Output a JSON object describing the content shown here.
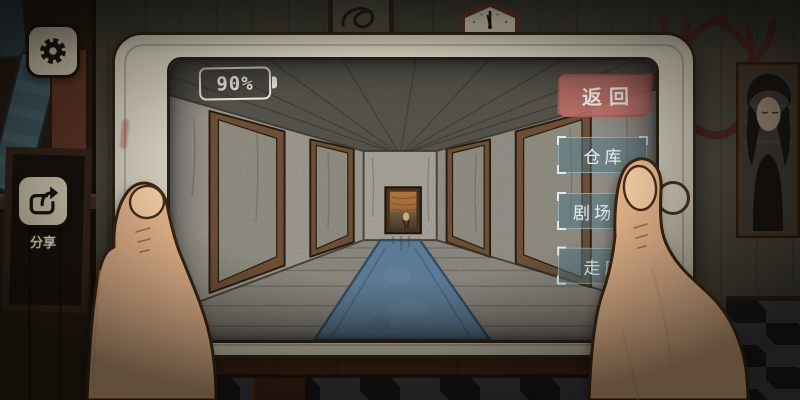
{
  "hud": {
    "settings_button": {
      "icon": "gear-icon"
    },
    "share_button": {
      "icon": "share-icon",
      "label": "分享"
    }
  },
  "tablet": {
    "battery": {
      "icon": "battery-icon",
      "label": "90%"
    },
    "back_button": {
      "label": "返回"
    },
    "nav_buttons": [
      {
        "label": "仓库"
      },
      {
        "label": "剧场屋"
      },
      {
        "label": "走廊"
      }
    ]
  },
  "colors": {
    "back_button": "#c2706a",
    "nav_button": "#507685",
    "carpet": "#5e7e9a",
    "tablet_bezel": "#cac5b5",
    "skin": "#e0b28a",
    "wall": "#45443b"
  }
}
